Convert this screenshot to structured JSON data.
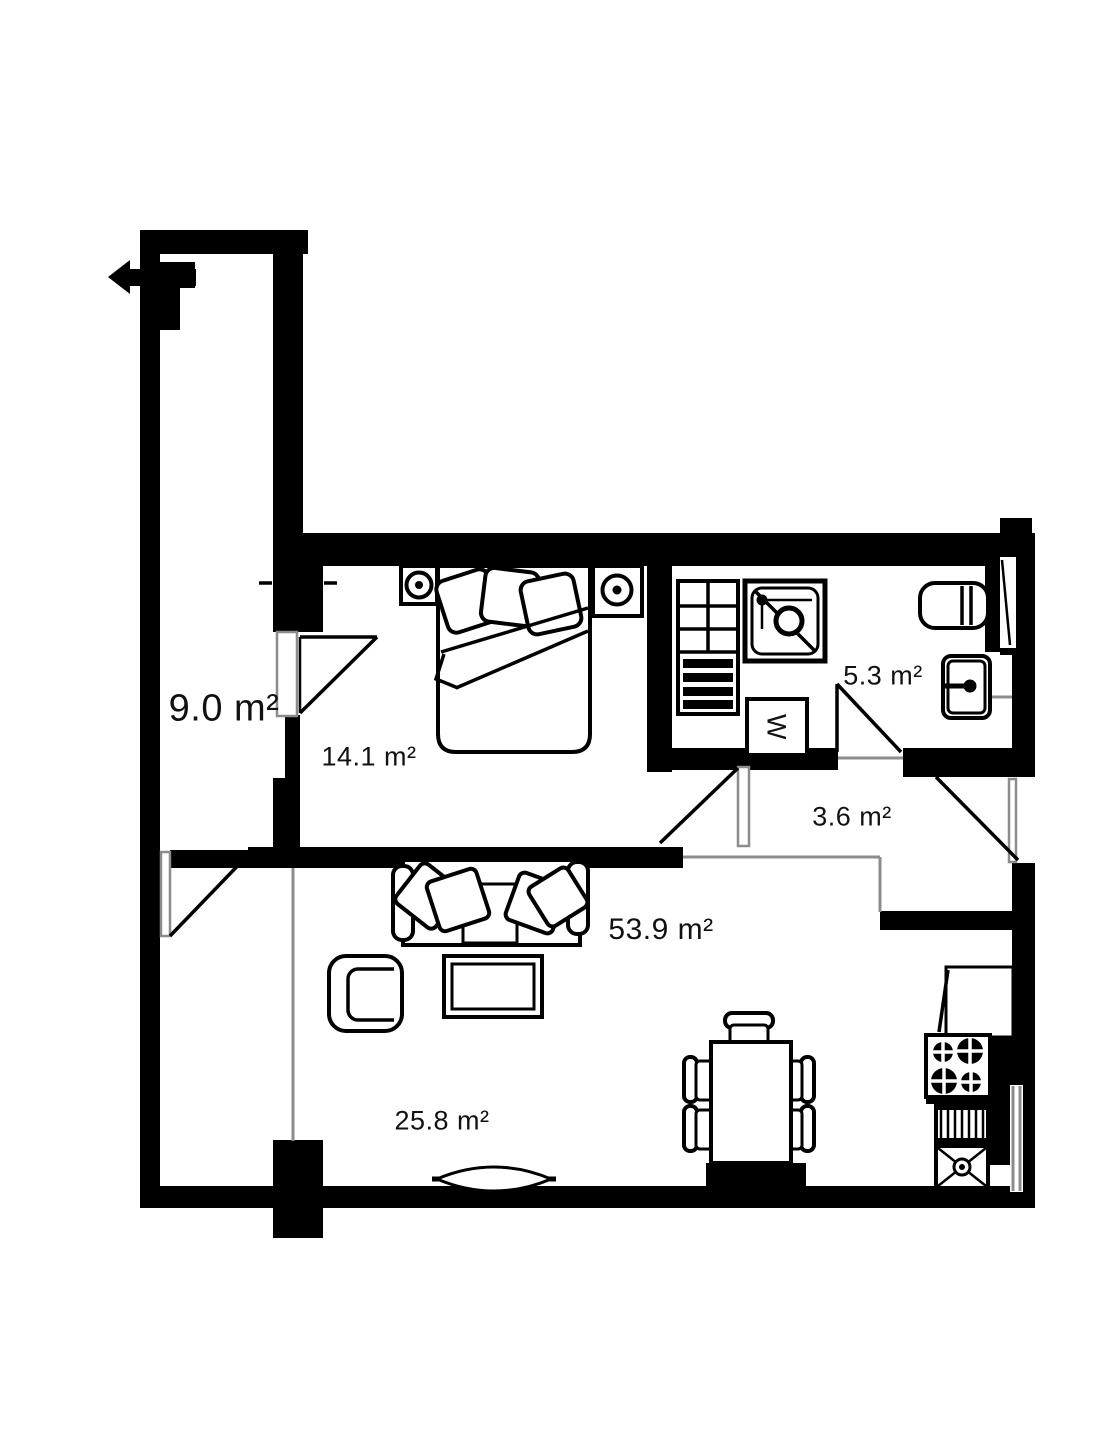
{
  "floorplan": {
    "drawing_type": "apartment-floor-plan",
    "colors": {
      "wall": "#000000",
      "floor": "#ffffff",
      "opening": "#8c8c8c"
    },
    "rooms": [
      {
        "id": "balcony-corridor",
        "area_label": "9.0 m²"
      },
      {
        "id": "bedroom",
        "area_label": "14.1 m²"
      },
      {
        "id": "bathroom",
        "area_label": "5.3 m²"
      },
      {
        "id": "hallway",
        "area_label": "3.6 m²"
      },
      {
        "id": "living-room",
        "area_label": "53.9 m²"
      },
      {
        "id": "living-dining-zone",
        "area_label": "25.8 m²"
      }
    ],
    "appliances": {
      "washing_machine_label": "W"
    }
  }
}
